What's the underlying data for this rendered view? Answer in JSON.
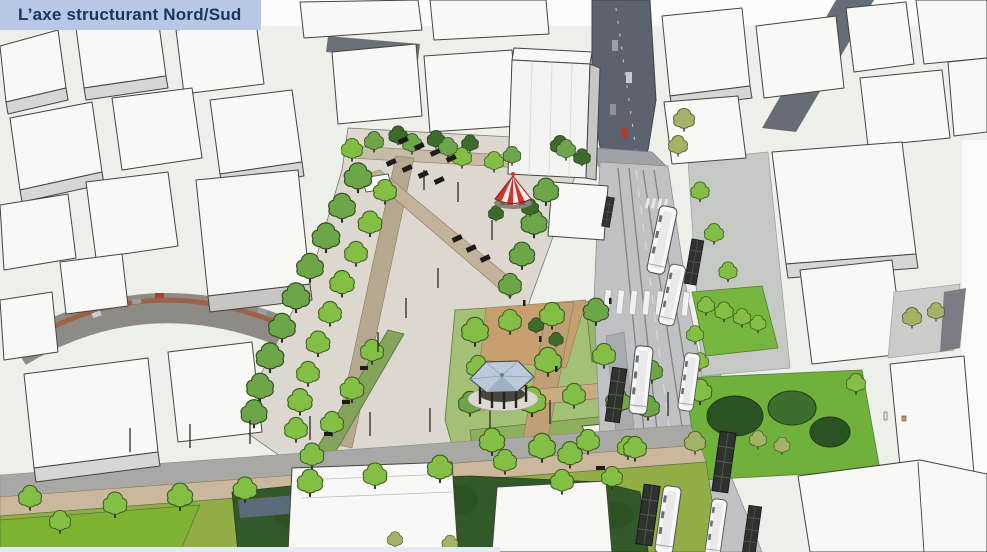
{
  "banner": {
    "title": "L’axe structurant Nord/Sud",
    "background_color": "#b7c7e5",
    "text_color": "#17355e"
  },
  "scene": {
    "kind": "3d-urban-massing-render",
    "landmarks": [
      {
        "name": "carousel",
        "roof_colors": [
          "#d8302b",
          "#f4efe6"
        ]
      },
      {
        "name": "bandstand-gazebo",
        "roof_color": "#bcc9da"
      },
      {
        "name": "tramway-avenue"
      },
      {
        "name": "tree-lined-promenade"
      },
      {
        "name": "garden-square"
      },
      {
        "name": "existing-streets-phototexture"
      }
    ],
    "palette": {
      "building_roof": "#f8f8f6",
      "building_side": "#d6d6d4",
      "outline": "#45453f",
      "plaza_paving": "#dcd8cf",
      "path_tan": "#bfa47c",
      "lawn_bright": "#79b43d",
      "lawn_olive": "#95ad48",
      "park_dark": "#33582a",
      "road_new": "#bfc1c3",
      "road_photo": "#5c636f",
      "tree_bright": "#83bf44",
      "tree_mid": "#6da649",
      "tree_olive": "#a3b264",
      "tree_dark": "#3c6b2c",
      "tram_body": "#f8f8f7",
      "shelter_dark": "#2f332e"
    }
  }
}
